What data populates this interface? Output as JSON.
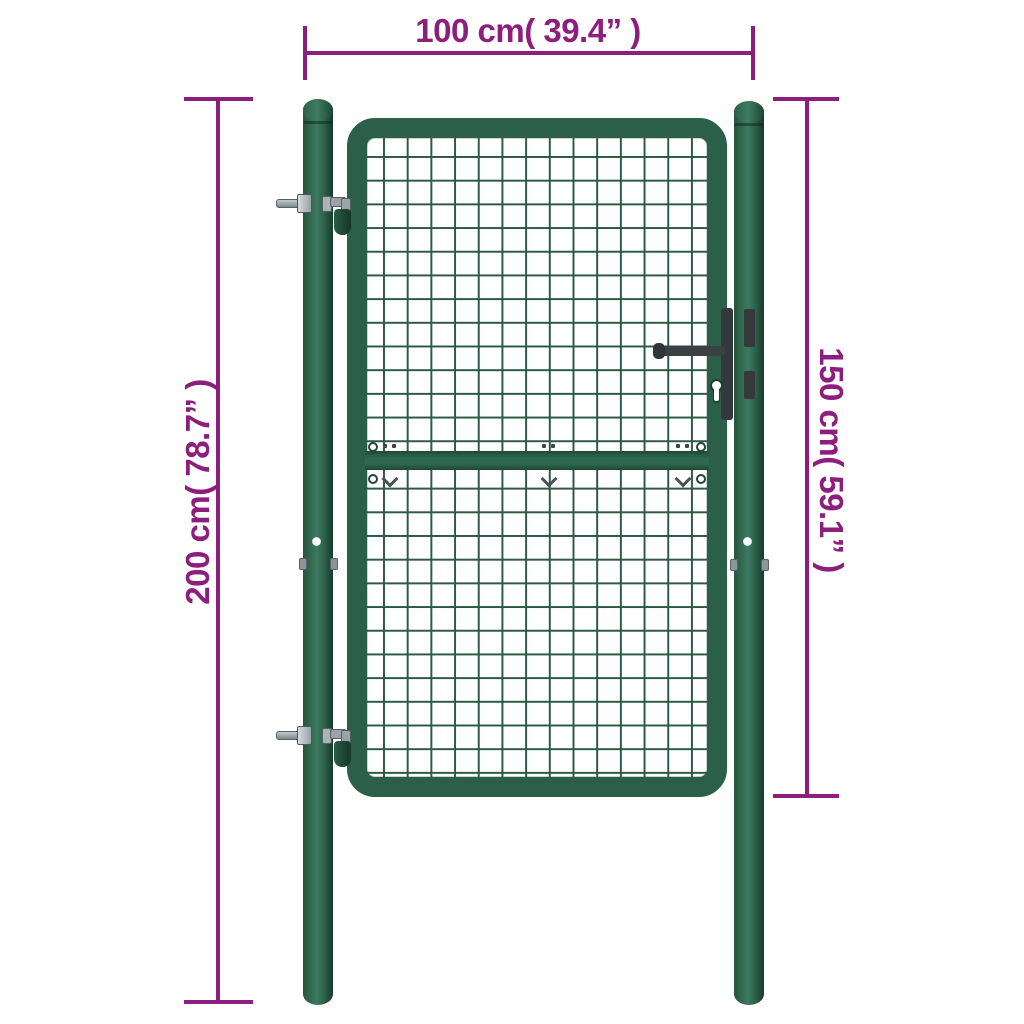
{
  "diagram": {
    "subject": "Mesh garden gate with round posts — dimension drawing",
    "dimensions": {
      "width": {
        "label": "100 cm( 39.4” )",
        "value_cm": 100,
        "value_inch": 39.4,
        "orientation": "horizontal-top"
      },
      "post_height": {
        "label": "200 cm( 78.7” )",
        "value_cm": 200,
        "value_inch": 78.7,
        "orientation": "vertical-left"
      },
      "gate_height": {
        "label": "150 cm( 59.1” )",
        "value_cm": 150,
        "value_inch": 59.1,
        "orientation": "vertical-right"
      }
    },
    "colors": {
      "dimension": "#8e1e7e",
      "gate_green": "#2b5f49",
      "mesh_line": "#2d5a47",
      "hardware_dark": "#36393c",
      "metal_gray": "#a9b2b6",
      "background": "#ffffff"
    },
    "parts": {
      "left_post": "round steel post",
      "right_post": "round steel post",
      "gate_frame": "rounded rectangular frame",
      "wire_mesh": "square wire mesh infill",
      "middle_rail": "horizontal reinforcement rail",
      "handle": "lever handle",
      "lock": "lock plate with keyhole",
      "hinges": "two bolt-on hinges"
    }
  }
}
